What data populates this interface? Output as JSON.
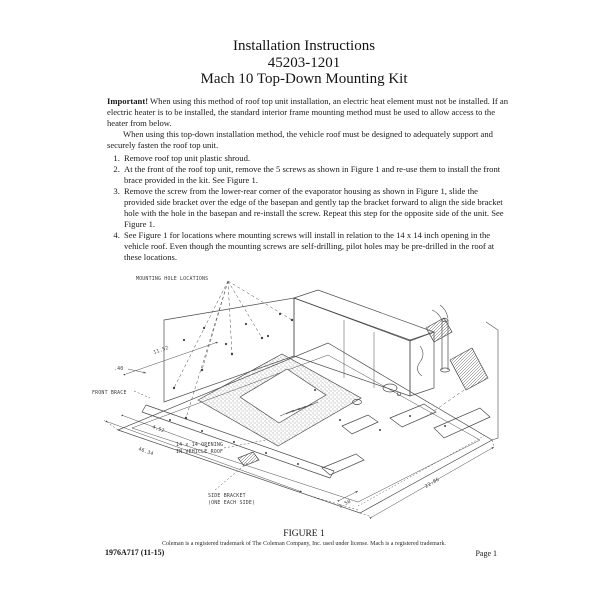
{
  "doc": {
    "title_line1": "Installation Instructions",
    "title_line2": "45203-1201",
    "title_line3": "Mach 10 Top-Down Mounting Kit",
    "important_label": "Important!",
    "important_rest": " When using this method of roof top unit installation, an electric heat element must not be installed.  If an electric heater is to be installed, the standard interior frame mounting method must be used to allow access to the heater from below.",
    "paragraph2": "When using this top-down installation method, the vehicle roof must be designed to adequately support and securely fasten the roof top unit.",
    "steps": [
      "Remove roof top unit plastic shroud.",
      "At the front of the roof top unit, remove the 5 screws as shown in Figure 1 and re-use them to install the front brace provided in the kit.  See Figure 1.",
      "Remove the screw from the lower-rear corner of the evaporator housing as shown in Figure 1, slide the provided side bracket over the edge of the basepan and gently tap the bracket forward to align the side bracket hole with the hole in the basepan and re-install the screw.  Repeat this step for the opposite side of the unit.  See Figure 1.",
      "See Figure 1 for locations where mounting screws will install in relation to the 14 x 14 inch opening in the vehicle roof.  Even though the mounting screws are self-drilling, pilot holes may be pre-drilled in the roof at these locations."
    ]
  },
  "figure": {
    "caption": "FIGURE 1",
    "labels": {
      "mounting_holes": "MOUNTING HOLE LOCATIONS",
      "front_brace": "FRONT BRACE",
      "opening1": "14 x 14 OPENING",
      "opening2": "IN VEHICLE ROOF",
      "side_bracket1": "SIDE BRACKET",
      "side_bracket2": "(ONE EACH SIDE)"
    },
    "dimensions": {
      "top_left": "11.52",
      "left": ".40",
      "front_upper": "4.52",
      "front_lower": "46.34",
      "bottom": "1.50",
      "right": "22.86"
    }
  },
  "footer": {
    "trademark": "Coleman is a registered trademark of The Coleman Company, Inc. used under license.  Mach is a registered trademark.",
    "doc_code": "1976A717 (11-15)",
    "page_label": "Page 1"
  }
}
